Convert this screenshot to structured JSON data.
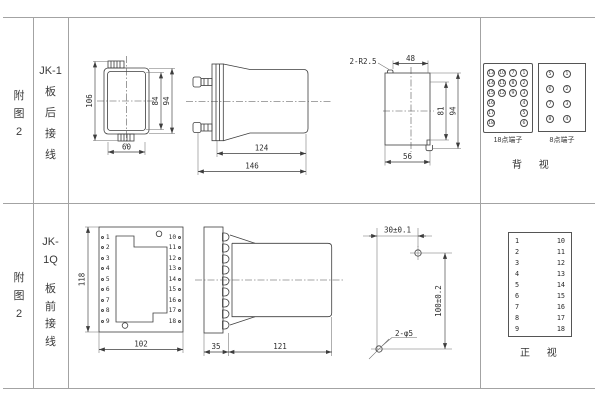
{
  "left_column": {
    "row1_label": "附图2",
    "row2_label": "附图2"
  },
  "type_column": {
    "row1_model": "JK-1",
    "row1_wiring": "板后接线",
    "row2_model": "JK-1Q",
    "row2_wiring": "板前接线"
  },
  "top_row": {
    "front_view": {
      "dims": {
        "height_total": "106",
        "height_inner": "84",
        "height_outer": "94",
        "width": "60"
      }
    },
    "side_view": {
      "dims": {
        "body_length": "124",
        "total_length": "146"
      }
    },
    "rear_view": {
      "dims": {
        "corner_radius": "2-R2.5",
        "top_width": "48",
        "height_inner": "81",
        "height_outer": "94",
        "bottom_width": "56"
      }
    },
    "terminal_18": {
      "label": "18点端子",
      "columns": [
        [
          13,
          14,
          15,
          16,
          17,
          18
        ],
        [
          10,
          11,
          12
        ],
        [
          7,
          8,
          9
        ],
        [
          1,
          2,
          3,
          4,
          5,
          6
        ]
      ]
    },
    "terminal_8": {
      "label": "8点端子",
      "columns": [
        [
          5,
          6,
          7,
          8
        ],
        [
          1,
          2,
          3,
          4
        ]
      ]
    },
    "view_label": "背 视"
  },
  "bottom_row": {
    "front_view": {
      "left_terminals": [
        "1",
        "2",
        "3",
        "4",
        "5",
        "6",
        "7",
        "8",
        "9"
      ],
      "right_terminals": [
        "10",
        "11",
        "12",
        "13",
        "14",
        "15",
        "16",
        "17",
        "18"
      ],
      "dims": {
        "height": "118",
        "width": "102"
      }
    },
    "side_view": {
      "dims": {
        "plate_depth": "35",
        "body_length": "121"
      }
    },
    "drilling": {
      "dims": {
        "spacing_x": "30±0.1",
        "spacing_y": "100±0.2",
        "holes": "2-φ5"
      }
    },
    "terminal_table": {
      "left": [
        "1",
        "2",
        "3",
        "4",
        "5",
        "6",
        "7",
        "8",
        "9"
      ],
      "right": [
        "10",
        "11",
        "12",
        "13",
        "14",
        "15",
        "16",
        "17",
        "18"
      ],
      "view_label": "正 视"
    }
  }
}
